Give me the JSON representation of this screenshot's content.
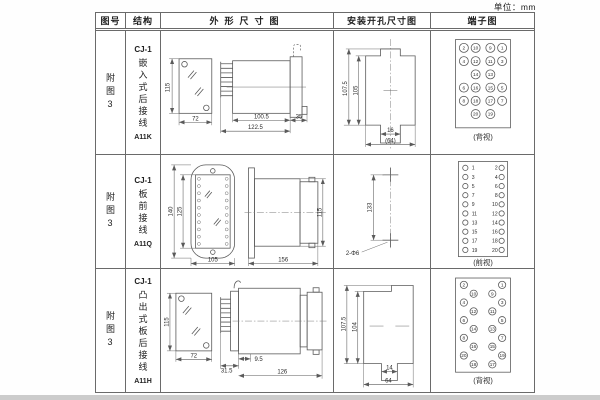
{
  "unit_label": "单位：mm",
  "table": {
    "headers": [
      "图号",
      "结构",
      "外形尺寸图",
      "安装开孔尺寸图",
      "端子图"
    ],
    "rows": [
      {
        "fig_no": "附图3",
        "model": "CJ-1",
        "structure_name": "嵌入式后接线",
        "code": "A11K",
        "outline": {
          "front_h": "115",
          "front_w": "72",
          "body_len": "100.5",
          "total_len": "122.5",
          "flange": "35"
        },
        "install": {
          "v_outer": "107.5",
          "v_inner": "105",
          "slot_w": "16",
          "overall_w": "(64)"
        },
        "terminal": {
          "view": "(背视)",
          "outer_left": [
            "2",
            "4",
            "6",
            "8"
          ],
          "inner_left": [
            "10",
            "12",
            "14",
            "16",
            "18",
            "20"
          ],
          "inner_right": [
            "9",
            "11",
            "13",
            "15",
            "17",
            "19"
          ],
          "outer_right": [
            "1",
            "3",
            "5",
            "7"
          ]
        }
      },
      {
        "fig_no": "附图3",
        "model": "CJ-1",
        "structure_name": "板前接线",
        "code": "A11Q",
        "outline": {
          "front_h": "140",
          "inner_h": "125",
          "front_w": "105",
          "body_len": "156",
          "side_h": "115"
        },
        "install": {
          "hole_dist": "133",
          "hole_label": "2-Φ6"
        },
        "terminal": {
          "view": "(前视)",
          "left": [
            "1",
            "3",
            "5",
            "7",
            "9",
            "11",
            "13",
            "15",
            "17",
            "19"
          ],
          "right": [
            "2",
            "4",
            "6",
            "8",
            "10",
            "12",
            "14",
            "16",
            "18",
            "20"
          ]
        }
      },
      {
        "fig_no": "附图3",
        "model": "CJ-1",
        "structure_name": "凸出式板后接线",
        "code": "A11H",
        "outline": {
          "front_h": "115",
          "front_w": "72",
          "pin_len": "31.5",
          "offset": "9.5",
          "body_len": "126"
        },
        "install": {
          "v_outer": "107.5",
          "v_inner": "104",
          "slot_w": "14",
          "overall_w": "64"
        },
        "terminal": {
          "view": "(背视)",
          "left": [
            "2",
            "10",
            "4",
            "12",
            "6",
            "14",
            "8",
            "16",
            "20",
            "18"
          ],
          "right": [
            "1",
            "9",
            "3",
            "11",
            "5",
            "13",
            "7",
            "15",
            "19",
            "17"
          ]
        }
      }
    ]
  }
}
